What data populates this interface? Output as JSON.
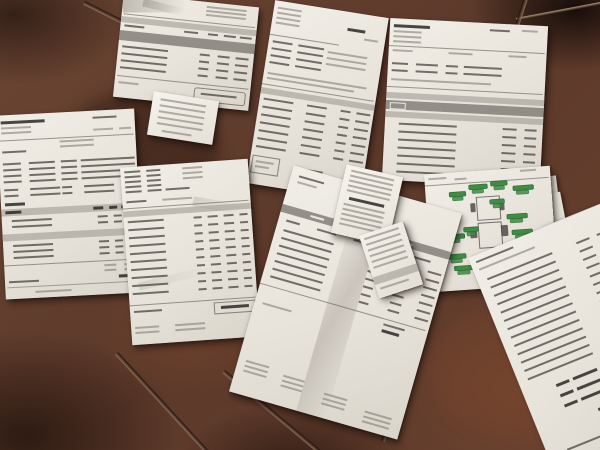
{
  "scene": {
    "type": "photograph",
    "subject": "Paper invoices, receipts and a vehicle parts diagram scattered on a brown tiled floor",
    "floor": {
      "tile_color": "#6b4533",
      "grout_color": "#9a7b61",
      "shadow_color": "#1f120c"
    },
    "paper_color": "#ece8e0",
    "ink_color": "#4a463f",
    "table_band_color": "#97938b",
    "accent_green": "#3f8c44",
    "documents": [
      {
        "label": "crumpled invoice, top left"
      },
      {
        "label": "invoice, top middle"
      },
      {
        "label": "invoice, top right"
      },
      {
        "label": "invoice with totals box, left"
      },
      {
        "label": "crumpled itemized invoice, center left"
      },
      {
        "label": "small receipt on left invoice"
      },
      {
        "label": "large tilted invoice, center"
      },
      {
        "label": "small receipt on center invoice"
      },
      {
        "label": "narrow receipt strip"
      },
      {
        "label": "vehicle diagram sheet with green part labels"
      },
      {
        "label": "itemized list sheet, bottom right"
      },
      {
        "label": "numeric list sheet, far right"
      }
    ]
  }
}
